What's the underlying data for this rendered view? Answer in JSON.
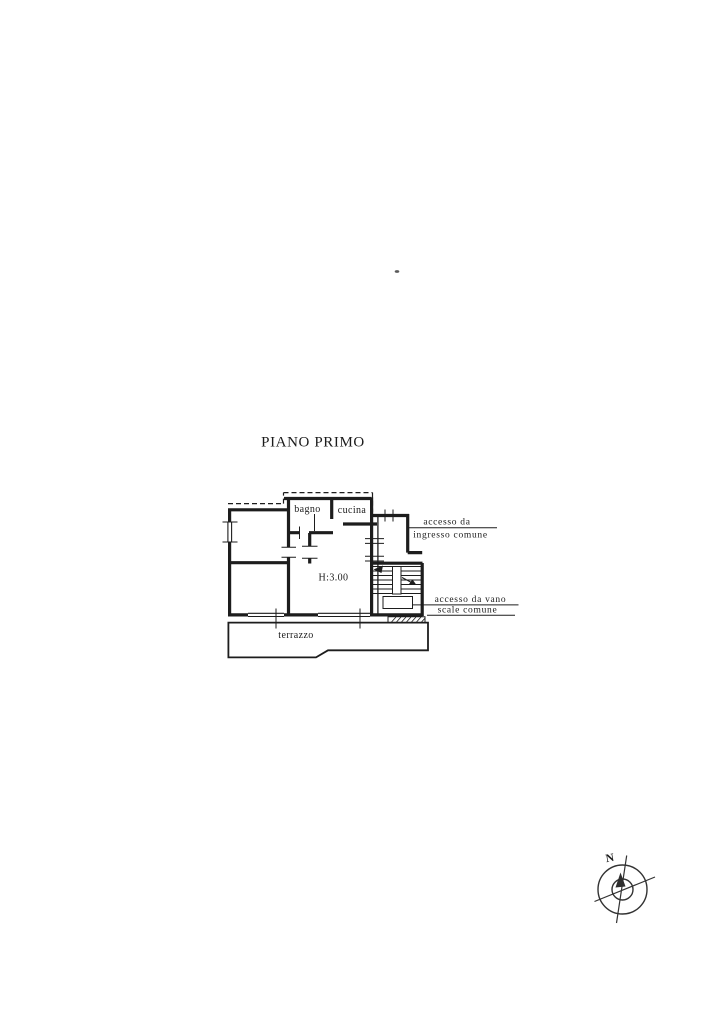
{
  "page": {
    "title": "PIANO PRIMO",
    "paper_color": "#ffffff",
    "ink_color": "#1d1d1d"
  },
  "floor_plan": {
    "height_note": "H:3.00",
    "rooms": {
      "bathroom": "bagno",
      "kitchen": "cucina",
      "terrace": "terrazzo"
    },
    "annotations": {
      "entrance": {
        "line1": "accesso da",
        "line2": "ingresso comune"
      },
      "stairwell": {
        "line1": "accesso da vano",
        "line2": "scale comune"
      }
    }
  },
  "compass": {
    "north_label": "N"
  }
}
